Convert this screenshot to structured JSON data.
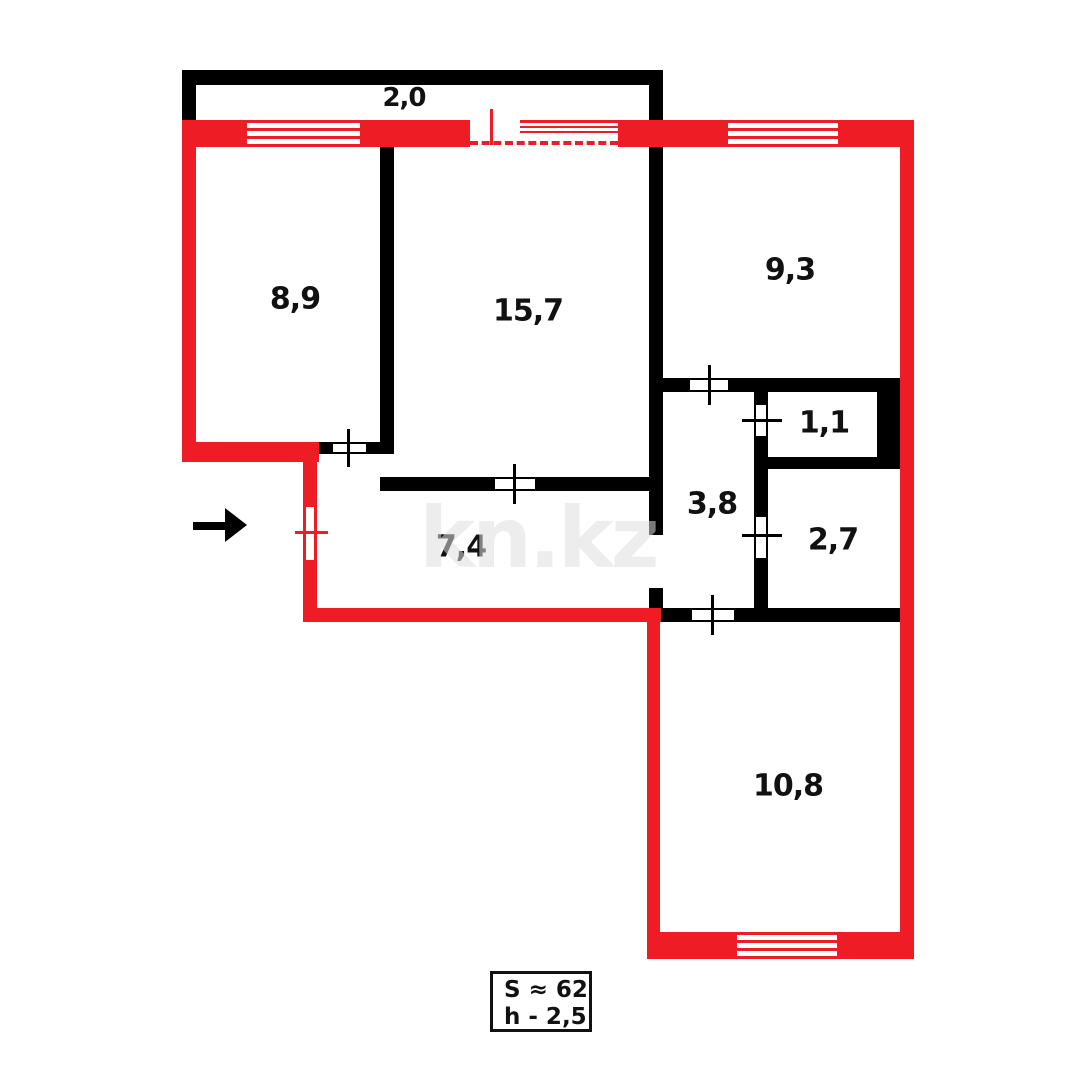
{
  "floor_plan": {
    "rooms": [
      {
        "id": "balcony",
        "area": "2,0"
      },
      {
        "id": "room-top-left",
        "area": "8,9"
      },
      {
        "id": "room-center",
        "area": "15,7"
      },
      {
        "id": "room-top-right",
        "area": "9,3"
      },
      {
        "id": "closet",
        "area": "1,1"
      },
      {
        "id": "corridor",
        "area": "3,8"
      },
      {
        "id": "bathroom",
        "area": "2,7"
      },
      {
        "id": "hallway",
        "area": "7,4"
      },
      {
        "id": "room-bottom",
        "area": "10,8"
      }
    ],
    "summary": {
      "total_area": "S ≈ 62",
      "ceiling_height": "h - 2,5"
    },
    "watermark": "kn.kz",
    "colors": {
      "exterior_wall": "#ee1c24",
      "interior_wall": "#000000",
      "label_text": "#111111",
      "watermark_gray": "#ebebeb"
    }
  }
}
